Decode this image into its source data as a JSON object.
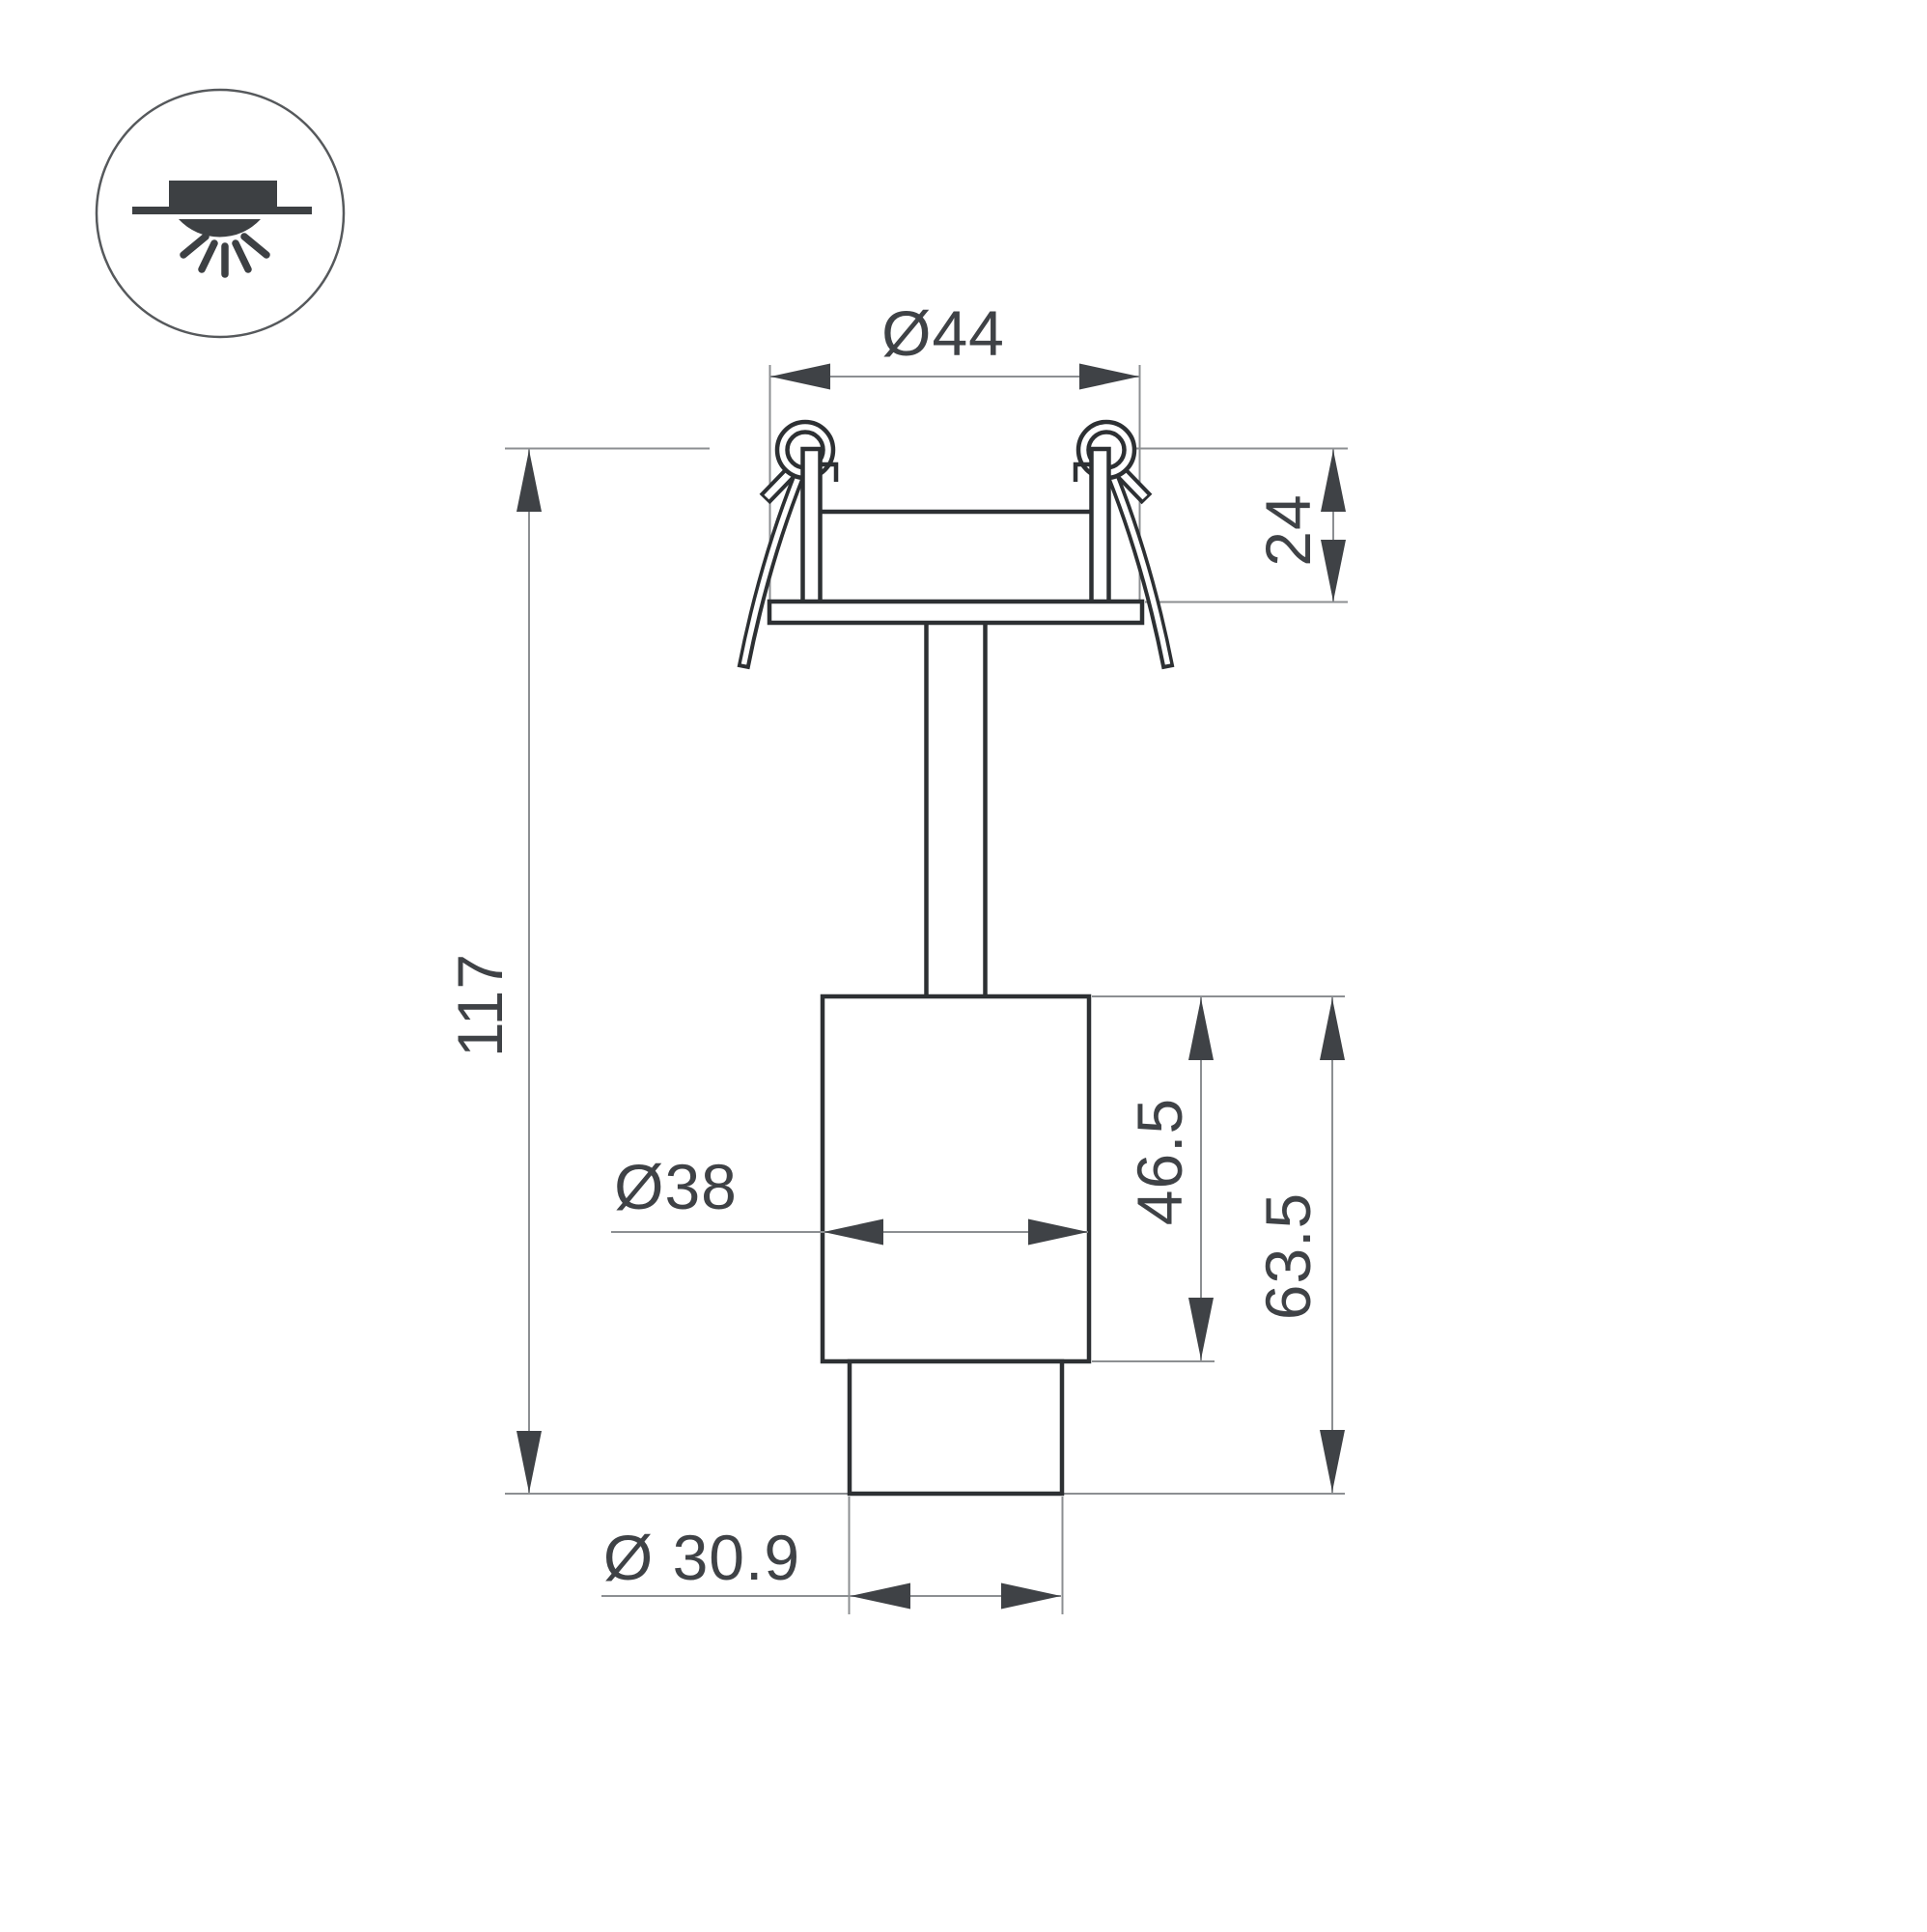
{
  "drawing": {
    "type": "technical-dimension-drawing",
    "subject": "recessed spotlight side view with spring clips",
    "icon": {
      "name": "recessed-mount-downlight-icon"
    },
    "labels": {
      "top_diameter": "Ø44",
      "recess_depth": "24",
      "total_height": "117",
      "body_diameter": "Ø38",
      "body_height": "46.5",
      "lower_section_height": "63.5",
      "bottom_diameter": "Ø 30.9"
    },
    "colors": {
      "background": "#ffffff",
      "outline": "#2d3033",
      "dimension_line": "#8c8f92",
      "arrow_and_text": "#3f4246",
      "icon_fill": "#3d4043"
    }
  }
}
